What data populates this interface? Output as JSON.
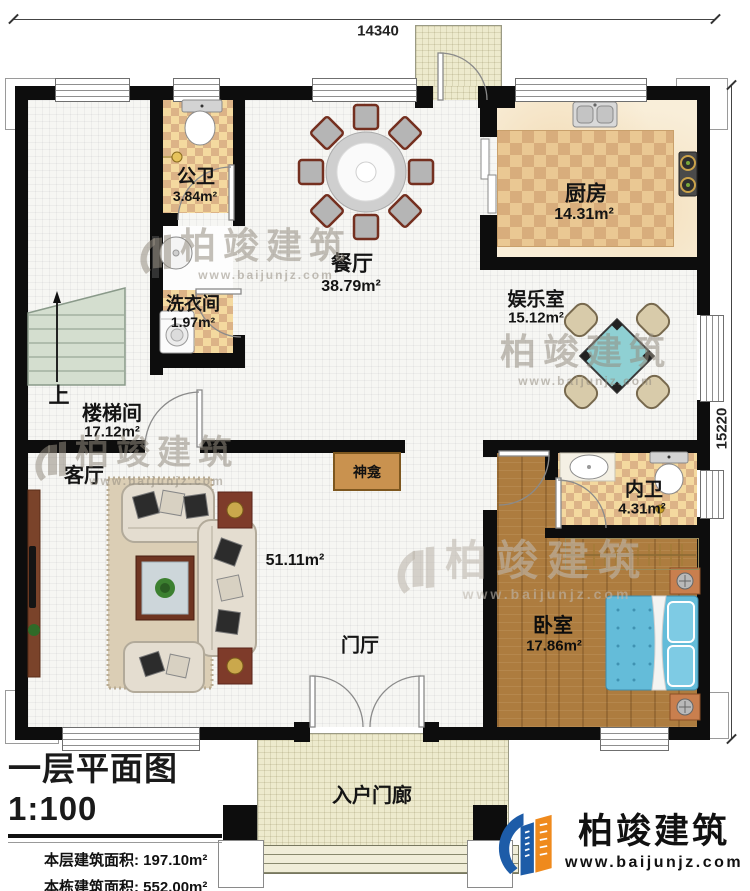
{
  "dimensions": {
    "top": "14340",
    "right": "15220"
  },
  "rooms": [
    {
      "name": "公卫",
      "area": "3.84m²"
    },
    {
      "name": "厨房",
      "area": "14.31m²"
    },
    {
      "name": "餐厅",
      "area": "38.79m²"
    },
    {
      "name": "洗衣间",
      "area": "1.97m²"
    },
    {
      "name": "娱乐室",
      "area": "15.12m²"
    },
    {
      "name": "楼梯间",
      "area": "17.12m²"
    },
    {
      "name": "客厅",
      "area": "51.11m²"
    },
    {
      "name": "内卫",
      "area": "4.31m²"
    },
    {
      "name": "卧室",
      "area": "17.86m²"
    },
    {
      "name": "门厅",
      "area": ""
    },
    {
      "name": "入户门廊",
      "area": ""
    },
    {
      "name": "神龛",
      "area": ""
    }
  ],
  "stair": {
    "up_label": "上"
  },
  "title_block": {
    "title": "一层平面图1:100",
    "stats": [
      {
        "label": "本层建筑面积:",
        "value": "197.10m²"
      },
      {
        "label": "本栋建筑面积:",
        "value": "552.00m²"
      },
      {
        "label": "占地面积:",
        "value": "197.1m²"
      },
      {
        "label": "层高:",
        "value": "4.5m"
      }
    ]
  },
  "watermark": {
    "brand": "柏竣建筑",
    "url": "www.baijunjz.com"
  },
  "logo": {
    "brand": "柏竣建筑",
    "url": "www.baijunjz.com"
  },
  "colors": {
    "wall": "#0d0d0d",
    "kitchen_tile": "#e9c893",
    "bath_tile": "#f4d99f",
    "wood_floor": "#ad7c3f",
    "bed_blue": "#64bcd9",
    "logo_blue": "#1d5ca8",
    "logo_orange": "#ef8a1d"
  }
}
